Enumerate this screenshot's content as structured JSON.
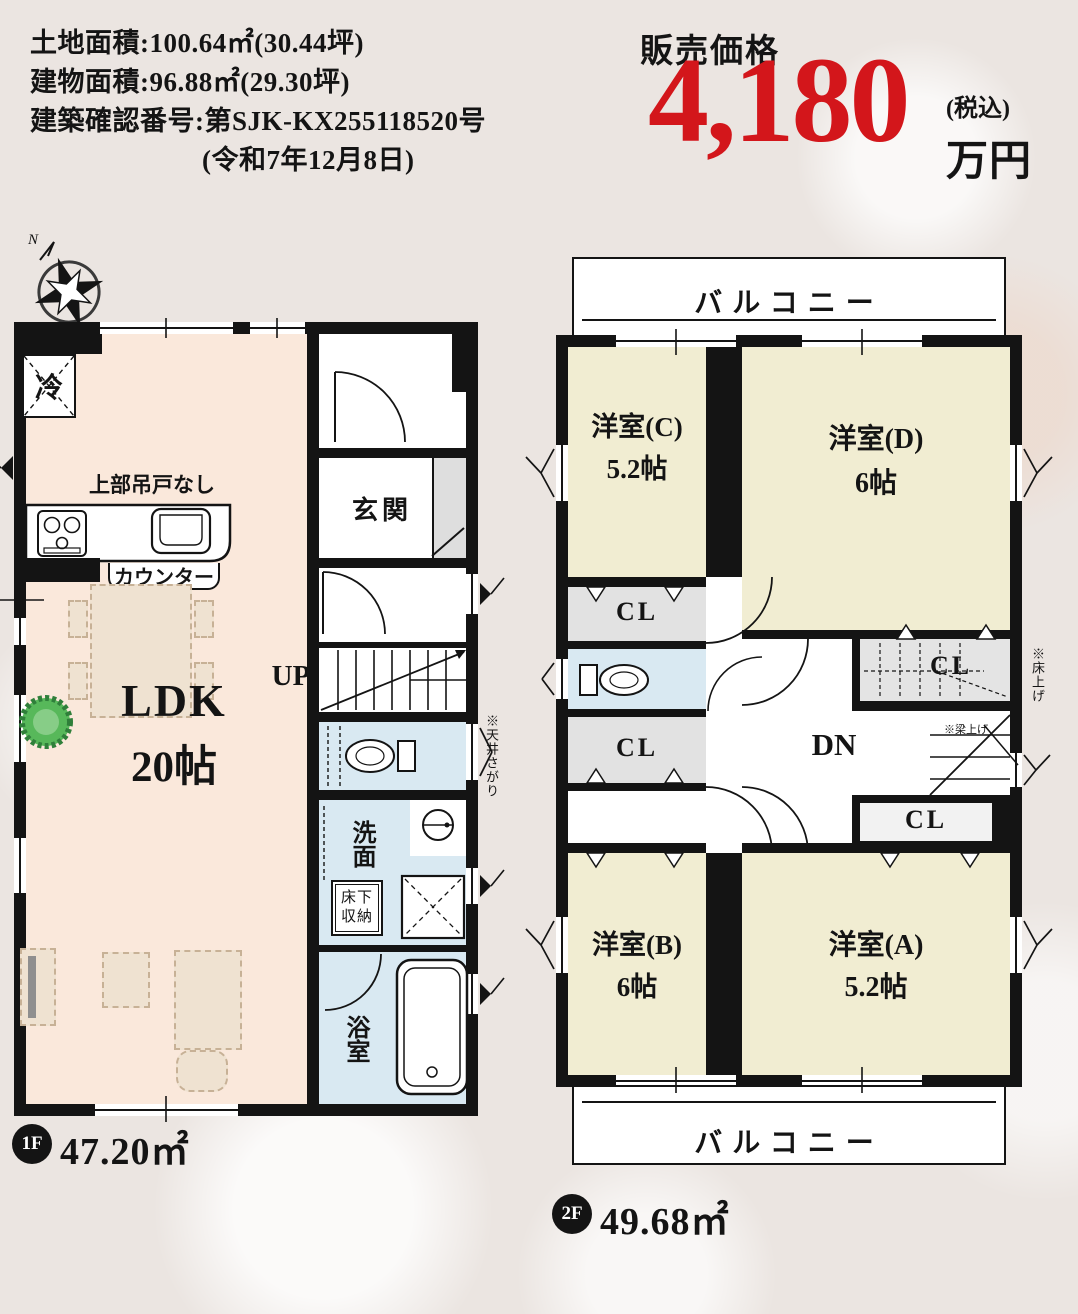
{
  "colors": {
    "price_red": "#D3161B",
    "wall_black": "#141414",
    "ldk_floor_peach": "#FAE8DB",
    "room_cream": "#F1EDD2",
    "wet_area_blue": "#D9E9F2",
    "closet_gray": "#E2E2E2",
    "background": "#EBE5E1"
  },
  "header": {
    "land_area": "土地面積:100.64㎡(30.44坪)",
    "building_area": "建物面積:96.88㎡(29.30坪)",
    "confirmation_number": "建築確認番号:第SJK-KX255118520号",
    "confirmation_date": "(令和7年12月8日)",
    "price_label": "販売価格",
    "price_value": "4,180",
    "price_tax": "(税込)",
    "price_unit": "万円"
  },
  "floor1": {
    "badge": "1F",
    "area": "47.20㎡",
    "compass_n": "N",
    "labels": {
      "fridge": "冷",
      "no_upper_cabinet": "上部吊戸なし",
      "counter": "カウンター",
      "genkan": "玄関",
      "up": "UP",
      "ldk": "LDK",
      "ldk_size": "20帖",
      "washroom": "洗面",
      "underfloor_storage": "床下収納",
      "washer": "洗",
      "bath": "浴室",
      "note_ceiling": "※天井さがり"
    }
  },
  "floor2": {
    "badge": "2F",
    "area": "49.68㎡",
    "labels": {
      "balcony": "バルコニー",
      "room_c": "洋室(C)",
      "room_c_size": "5.2帖",
      "room_d": "洋室(D)",
      "room_d_size": "6帖",
      "room_b": "洋室(B)",
      "room_b_size": "6帖",
      "room_a": "洋室(A)",
      "room_a_size": "5.2帖",
      "cl": "CL",
      "dn": "DN",
      "note_floor_raised": "※床上げ",
      "note_beam_raised": "※梁上げ"
    }
  }
}
